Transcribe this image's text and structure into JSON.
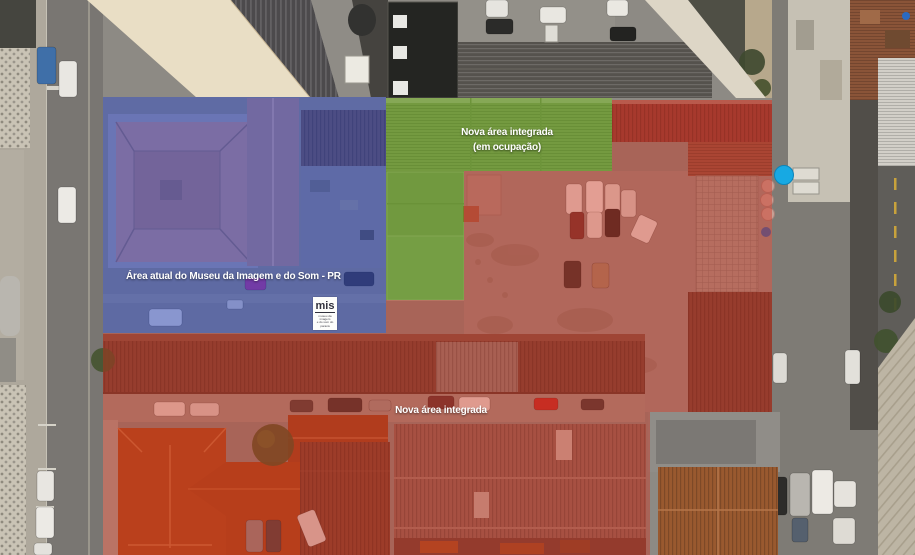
{
  "regions": {
    "blue": {
      "label": "Área atual do Museu da Imagem e do Som - PR",
      "color": "#1c3ecb",
      "opacity": "0.42"
    },
    "green": {
      "label_line1": "Nova área integrada",
      "label_line2": "(em ocupação)",
      "color": "#55930f",
      "opacity": "0.55"
    },
    "red": {
      "label": "Nova área integrada",
      "color": "#d32b16",
      "opacity": "0.40"
    }
  },
  "logo": {
    "acronym": "mis",
    "sub_line1": "museu da imagem",
    "sub_line2": "e do som do paraná"
  },
  "landmarks": {
    "water_tank_color": "#17a9e3"
  }
}
